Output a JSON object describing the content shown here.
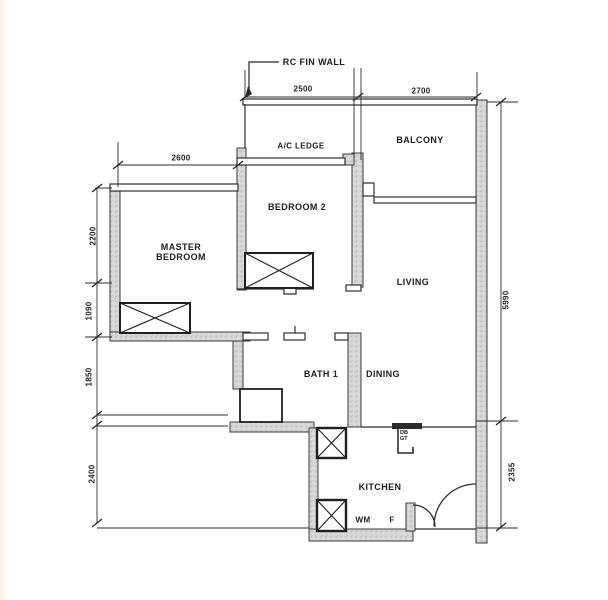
{
  "drawing": {
    "type": "apartment floor plan (scanned)",
    "callout": "RC FIN WALL",
    "rooms": {
      "balcony": "BALCONY",
      "ac_ledge": "A/C LEDGE",
      "bedroom2": "BEDROOM 2",
      "master_line1": "MASTER",
      "master_line2": "BEDROOM",
      "living": "LIVING",
      "bath1": "BATH 1",
      "dining": "DINING",
      "kitchen": "KITCHEN"
    },
    "fixtures": {
      "wm": "WM",
      "fridge": "F",
      "db_line1": "DB",
      "db_line2": "GT"
    },
    "dimensions": {
      "top_left": "2500",
      "top_right": "2700",
      "master_width": "2600",
      "master_height": "2200",
      "left_mid": "1090",
      "left_lower": "1850",
      "left_bottom": "2400",
      "right_height": "5990",
      "right_bottom": "2355"
    },
    "colors": {
      "wall_fill": "#d6d6d6",
      "ink": "#2e2e2e",
      "paper": "#ffffff"
    }
  }
}
